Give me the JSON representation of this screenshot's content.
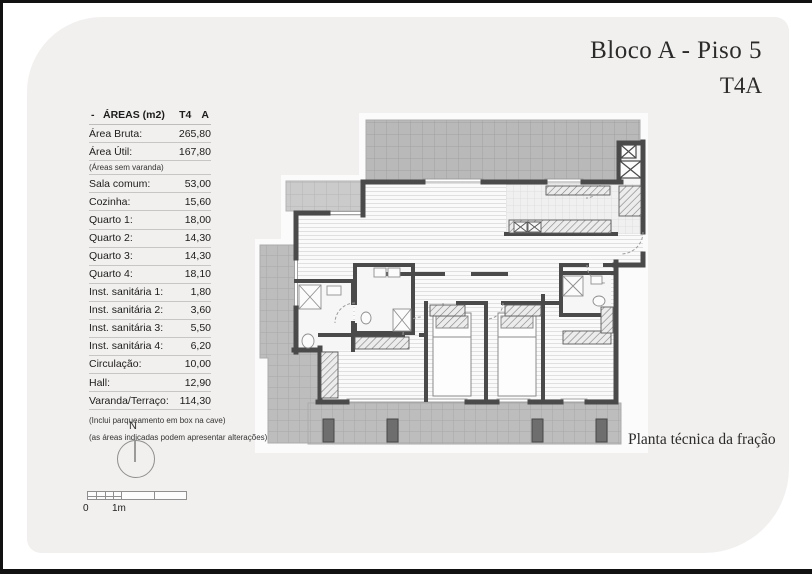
{
  "title": {
    "line1": "Bloco A - Piso 5",
    "line2": "T4A"
  },
  "areas_table": {
    "dash": "-",
    "title": "ÁREAS (m2)",
    "type_col": "T4",
    "fraction_col": "A",
    "rows": [
      {
        "label": "Área Bruta:",
        "value": "265,80"
      },
      {
        "label": "Área Útil:",
        "value": "167,80"
      },
      {
        "label": "(Áreas sem varanda)",
        "value": "",
        "note": true
      },
      {
        "label": "Sala comum:",
        "value": "53,00"
      },
      {
        "label": "Cozinha:",
        "value": "15,60"
      },
      {
        "label": "Quarto 1:",
        "value": "18,00"
      },
      {
        "label": "Quarto 2:",
        "value": "14,30"
      },
      {
        "label": "Quarto 3:",
        "value": "14,30"
      },
      {
        "label": "Quarto 4:",
        "value": "18,10"
      },
      {
        "label": "Inst. sanitária 1:",
        "value": "1,80"
      },
      {
        "label": "Inst. sanitária 2:",
        "value": "3,60"
      },
      {
        "label": "Inst. sanitária 3:",
        "value": "5,50"
      },
      {
        "label": "Inst. sanitária 4:",
        "value": "6,20"
      },
      {
        "label": "Circulação:",
        "value": "10,00"
      },
      {
        "label": "Hall:",
        "value": "12,90"
      },
      {
        "label": "Varanda/Terraço:",
        "value": "114,30"
      }
    ],
    "footnotes": [
      "(Inclui parqueamento em box na cave)",
      "(as áreas indicadas podem apresentar alterações)"
    ]
  },
  "compass": {
    "north": "N"
  },
  "scale": {
    "zero": "0",
    "one": "1m"
  },
  "caption": "Planta técnica da fração",
  "colors": {
    "card_bg": "#f1f0ee",
    "wall": "#4a4a4a",
    "terrace_dark": "#b9b9b9",
    "terrace_light": "#cbcbcb",
    "terrace_bottom": "#bdbdbd",
    "floor_stripe_bg": "#fafafa"
  }
}
